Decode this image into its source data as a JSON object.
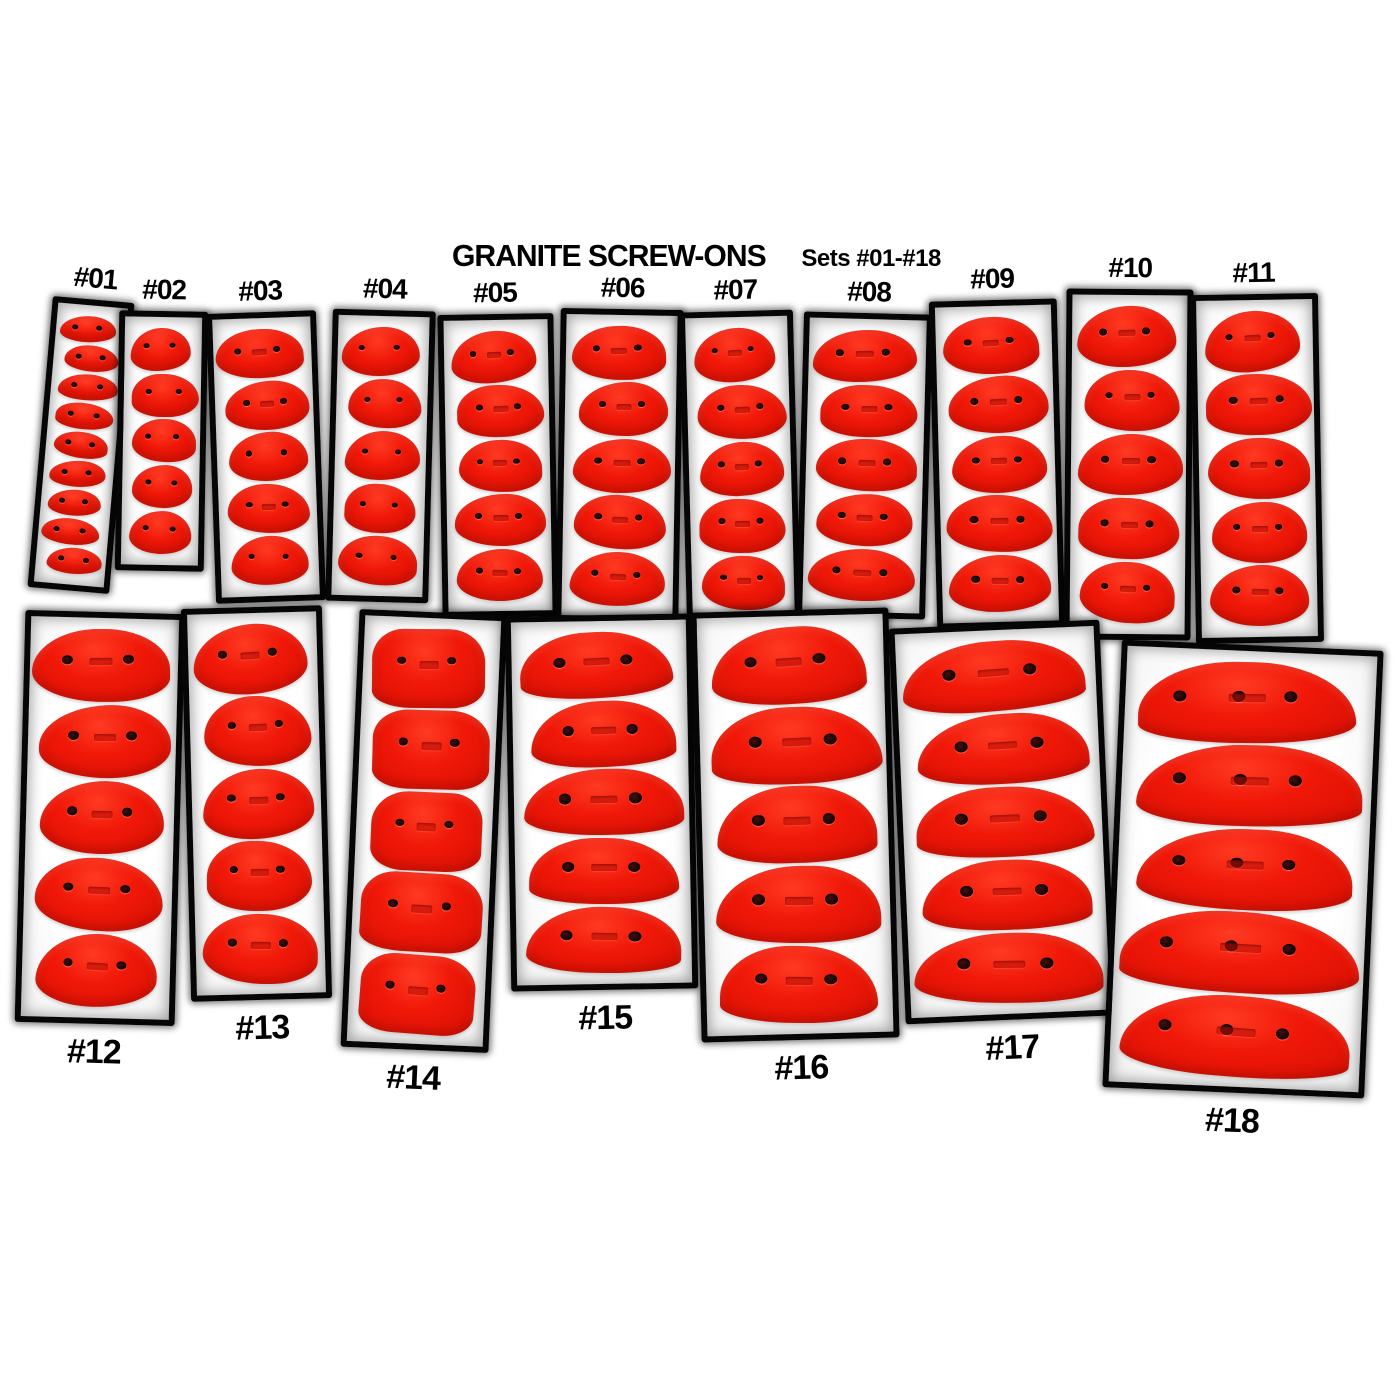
{
  "title": "GRANITE SCREW-ONS",
  "subtitle": "Sets #01-#18",
  "product_line": "Granite Screw-Ons",
  "colors": {
    "background": "#ffffff",
    "hold_red": "#f01808",
    "hold_red_highlight": "#ff3a22",
    "hold_red_shadow": "#c80f03",
    "panel_border": "#060606",
    "label_text": "#000000"
  },
  "sets": [
    {
      "label": "#01",
      "hold_count": 9,
      "holes_per_hold": 2,
      "shape": "blob",
      "layout": {
        "x": 40,
        "y": 299,
        "w": 82,
        "h": 292,
        "rot": 5,
        "label_pos": "above"
      }
    },
    {
      "label": "#02",
      "hold_count": 5,
      "holes_per_hold": 2,
      "shape": "blob",
      "layout": {
        "x": 117,
        "y": 311,
        "w": 89,
        "h": 260,
        "rot": 1,
        "label_pos": "above"
      }
    },
    {
      "label": "#03",
      "hold_count": 5,
      "holes_per_hold": 2,
      "shape": "blob",
      "layout": {
        "x": 211,
        "y": 312,
        "w": 110,
        "h": 290,
        "rot": -2,
        "label_pos": "above"
      }
    },
    {
      "label": "#04",
      "hold_count": 5,
      "holes_per_hold": 2,
      "shape": "blob",
      "layout": {
        "x": 329,
        "y": 310,
        "w": 103,
        "h": 292,
        "rot": 1.5,
        "label_pos": "above"
      }
    },
    {
      "label": "#05",
      "hold_count": 5,
      "holes_per_hold": 2,
      "shape": "blob",
      "layout": {
        "x": 440,
        "y": 314,
        "w": 116,
        "h": 303,
        "rot": -1,
        "label_pos": "above"
      }
    },
    {
      "label": "#06",
      "hold_count": 5,
      "holes_per_hold": 2,
      "shape": "blob",
      "layout": {
        "x": 558,
        "y": 309,
        "w": 123,
        "h": 313,
        "rot": 1,
        "label_pos": "above"
      }
    },
    {
      "label": "#07",
      "hold_count": 5,
      "holes_per_hold": 2,
      "shape": "blob",
      "layout": {
        "x": 683,
        "y": 311,
        "w": 114,
        "h": 316,
        "rot": -1.5,
        "label_pos": "above"
      }
    },
    {
      "label": "#08",
      "hold_count": 5,
      "holes_per_hold": 2,
      "shape": "blob",
      "layout": {
        "x": 800,
        "y": 313,
        "w": 129,
        "h": 305,
        "rot": 1.5,
        "label_pos": "above"
      }
    },
    {
      "label": "#09",
      "hold_count": 5,
      "holes_per_hold": 2,
      "shape": "blob",
      "layout": {
        "x": 933,
        "y": 300,
        "w": 128,
        "h": 328,
        "rot": -1.5,
        "label_pos": "above"
      }
    },
    {
      "label": "#10",
      "hold_count": 5,
      "holes_per_hold": 2,
      "shape": "blob",
      "layout": {
        "x": 1065,
        "y": 289,
        "w": 127,
        "h": 351,
        "rot": 0.5,
        "label_pos": "above"
      }
    },
    {
      "label": "#11",
      "hold_count": 5,
      "holes_per_hold": 2,
      "shape": "blob",
      "layout": {
        "x": 1193,
        "y": 294,
        "w": 128,
        "h": 349,
        "rot": -1,
        "label_pos": "above"
      }
    },
    {
      "label": "#12",
      "hold_count": 5,
      "holes_per_hold": 2,
      "shape": "blob",
      "layout": {
        "x": 20,
        "y": 612,
        "w": 160,
        "h": 412,
        "rot": 1.5,
        "label_pos": "below"
      }
    },
    {
      "label": "#13",
      "hold_count": 5,
      "holes_per_hold": 2,
      "shape": "blob",
      "layout": {
        "x": 186,
        "y": 607,
        "w": 141,
        "h": 393,
        "rot": -1.5,
        "label_pos": "below"
      }
    },
    {
      "label": "#14",
      "hold_count": 5,
      "holes_per_hold": 2,
      "shape": "blocky",
      "layout": {
        "x": 350,
        "y": 612,
        "w": 148,
        "h": 438,
        "rot": 2.5,
        "label_pos": "below"
      }
    },
    {
      "label": "#15",
      "hold_count": 5,
      "holes_per_hold": 2,
      "shape": "crescent",
      "layout": {
        "x": 508,
        "y": 615,
        "w": 187,
        "h": 375,
        "rot": -1,
        "label_pos": "below"
      }
    },
    {
      "label": "#16",
      "hold_count": 5,
      "holes_per_hold": 2,
      "shape": "crescent",
      "layout": {
        "x": 696,
        "y": 610,
        "w": 198,
        "h": 430,
        "rot": -1.5,
        "label_pos": "below"
      }
    },
    {
      "label": "#17",
      "hold_count": 5,
      "holes_per_hold": 2,
      "shape": "crescent",
      "layout": {
        "x": 897,
        "y": 624,
        "w": 211,
        "h": 396,
        "rot": -2.5,
        "label_pos": "below"
      }
    },
    {
      "label": "#18",
      "hold_count": 5,
      "holes_per_hold": 3,
      "shape": "crescent",
      "layout": {
        "x": 1112,
        "y": 645,
        "w": 262,
        "h": 448,
        "rot": 2.5,
        "label_pos": "below"
      }
    }
  ]
}
